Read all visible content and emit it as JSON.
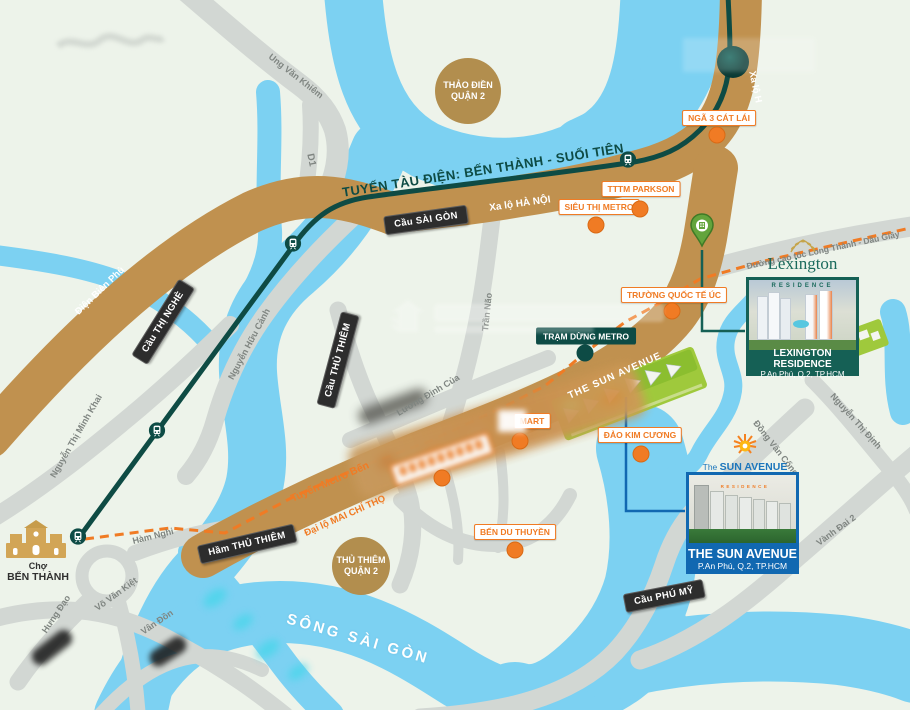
{
  "palette": {
    "land": "#EDF3EA",
    "water": "#7CD1F2",
    "road_gray": "#D2D7D3",
    "road_brown": "#C0914F",
    "metro_teal": "#0E4B44",
    "poi_orange": "#F07B24",
    "bridge_label": "#2D2D2D",
    "district_circle": "#B28E4E",
    "lexington_teal": "#156055",
    "sun_blue": "#1168B1"
  },
  "labels": {
    "streets": [
      {
        "n": "street-ung-van-khiem",
        "t": "Ung Văn Khiêm",
        "x": 296,
        "y": 76,
        "r": 38,
        "s": 9
      },
      {
        "n": "street-d1",
        "t": "D1",
        "x": 311,
        "y": 160,
        "r": 78,
        "s": 10
      },
      {
        "n": "street-nguyen-huu-canh",
        "t": "Nguyễn Hữu Cảnh",
        "x": 249,
        "y": 344,
        "r": -62,
        "s": 9
      },
      {
        "n": "street-nguyen-thi-minh-khai",
        "t": "Nguyễn Thị Minh Khai",
        "x": 76,
        "y": 436,
        "r": -60,
        "s": 9
      },
      {
        "n": "street-tran-nao",
        "t": "Trần Não",
        "x": 487,
        "y": 312,
        "r": -84,
        "s": 9
      },
      {
        "n": "street-luong-dinh-cua",
        "t": "Lương Định Của",
        "x": 428,
        "y": 395,
        "r": -31,
        "s": 9
      },
      {
        "n": "street-ham-nghi",
        "t": "Hàm Nghi",
        "x": 153,
        "y": 536,
        "r": -14,
        "s": 9
      },
      {
        "n": "street-vo-van-kiet",
        "t": "Võ Văn Kiệt",
        "x": 116,
        "y": 594,
        "r": -36,
        "s": 9
      },
      {
        "n": "street-van-don",
        "t": "Vân Đồn",
        "x": 157,
        "y": 622,
        "r": -34,
        "s": 9
      },
      {
        "n": "street-hung-dao",
        "t": "Hưng Đạo",
        "x": 56,
        "y": 614,
        "r": -56,
        "s": 9
      },
      {
        "n": "street-dong-van-cong",
        "t": "Đồng Văn Cống",
        "x": 776,
        "y": 448,
        "r": 52,
        "s": 9
      },
      {
        "n": "street-nguyen-thi-dinh",
        "t": "Nguyễn Thị Định",
        "x": 856,
        "y": 421,
        "r": 48,
        "s": 9
      },
      {
        "n": "street-vanh-dai-2",
        "t": "Vành Đai 2",
        "x": 836,
        "y": 530,
        "r": -36,
        "s": 9
      },
      {
        "n": "street-cao-toc-long-thanh",
        "t": "Đường cao tốc Long Thành - Dầu Giây",
        "x": 823,
        "y": 250,
        "r": -12,
        "s": 8.5
      }
    ],
    "road_white": [
      {
        "n": "road-dien-bien-phu",
        "t": "Điện Biên Phủ",
        "x": 100,
        "y": 291,
        "r": -44,
        "s": 9.5
      },
      {
        "n": "road-xa-lo-ha-noi",
        "t": "Xa lộ HÀ NỘI",
        "x": 520,
        "y": 204,
        "r": -8,
        "s": 10
      },
      {
        "n": "road-the-sun-avenue",
        "t": "THE SUN AVENUE",
        "x": 615,
        "y": 376,
        "r": -24,
        "s": 10,
        "ls": 1
      },
      {
        "n": "road-xa-lo-h",
        "t": "Xa lộ H",
        "x": 755,
        "y": 87,
        "r": 78,
        "s": 9.5
      }
    ],
    "road_orange": [
      {
        "n": "road-mai-chi-tho",
        "t": "Đại lộ MAI CHÍ THỌ",
        "x": 345,
        "y": 516,
        "r": -24,
        "s": 9.5
      },
      {
        "n": "road-tuyen-metro",
        "t": "Tuyến Metro Bến",
        "x": 330,
        "y": 482,
        "r": -24,
        "s": 10.5
      }
    ],
    "metro_line_label": {
      "n": "metro-line-label",
      "t": "TUYẾN TÀU ĐIỆN: BẾN THÀNH - SUỐI TIÊN",
      "x": 483,
      "y": 170,
      "r": -9,
      "s": 13
    },
    "river_label": {
      "n": "river-name",
      "t": "SÔNG SÀI GÒN",
      "x": 358,
      "y": 639,
      "r": 16,
      "s": 15
    },
    "districts": [
      {
        "n": "district-thao-dien",
        "l1": "THẢO ĐIỀN",
        "l2": "QUẬN 2",
        "x": 468,
        "y": 91,
        "d": 66
      },
      {
        "n": "district-thu-thiem",
        "l1": "THỦ THIÊM",
        "l2": "QUẬN 2",
        "x": 361,
        "y": 566,
        "d": 58
      }
    ],
    "bridges": [
      {
        "n": "bridge-cau-sai-gon",
        "t": "Cầu SÀI GÒN",
        "x": 426,
        "y": 220,
        "r": -8
      },
      {
        "n": "bridge-cau-thi-nghe",
        "t": "Cầu THỊ NGHÈ",
        "x": 163,
        "y": 322,
        "r": -58
      },
      {
        "n": "bridge-cau-thu-thiem",
        "t": "Cầu THỦ THIÊM",
        "x": 338,
        "y": 360,
        "r": -75
      },
      {
        "n": "bridge-ham-thu-thiem",
        "t": "Hầm THỦ THIÊM",
        "x": 247,
        "y": 544,
        "r": -13
      },
      {
        "n": "bridge-cau-phu-my",
        "t": "Cầu PHÚ MỸ",
        "x": 664,
        "y": 596,
        "r": -11
      }
    ],
    "pois": [
      {
        "n": "poi-nga-3-cat-lai",
        "t": "NGÃ 3 CÁT LÁI",
        "x": 719,
        "y": 118,
        "dot": [
          717,
          135
        ]
      },
      {
        "n": "poi-tttm-parkson",
        "t": "TTTM PARKSON",
        "x": 641,
        "y": 189,
        "dot": [
          640,
          209
        ]
      },
      {
        "n": "poi-sieu-thi-metro",
        "t": "SIÊU THỊ METRO",
        "x": 599,
        "y": 207,
        "dot": [
          596,
          225
        ]
      },
      {
        "n": "poi-truong-quoc-te-uc",
        "t": "TRƯỜNG QUỐC TẾ ÚC",
        "x": 674,
        "y": 295,
        "dot": [
          672,
          311
        ]
      },
      {
        "n": "poi-mart",
        "t": "MART",
        "x": 532,
        "y": 421,
        "dot": [
          520,
          441
        ]
      },
      {
        "n": "poi-dao-kim-cuong",
        "t": "ĐẢO KIM CƯƠNG",
        "x": 640,
        "y": 435,
        "dot": [
          641,
          454
        ]
      },
      {
        "n": "poi-ben-du-thuyen",
        "t": "BẾN DU THUYỀN",
        "x": 515,
        "y": 532,
        "dot": [
          515,
          550
        ]
      }
    ],
    "poi_dark": [
      {
        "n": "poi-tram-dung-metro",
        "t": "TRẠM DỪNG METRO",
        "x": 586,
        "y": 336,
        "dot": [
          585,
          353
        ]
      }
    ]
  },
  "metro": {
    "stations": [
      [
        78,
        539
      ],
      [
        157,
        433
      ],
      [
        293,
        246
      ],
      [
        628,
        162
      ]
    ],
    "terminal": [
      733,
      62
    ]
  },
  "extra_dots": [
    [
      442,
      478
    ]
  ],
  "ben_thanh": {
    "line1": "Chợ",
    "line2": "BẾN THÀNH"
  },
  "lexington": {
    "logo": "Lexington",
    "logo_sub": "RESIDENCE",
    "title": "LEXINGTON RESIDENCE",
    "address": "P.An Phú, Q.2, TP.HCM"
  },
  "sun_avenue": {
    "logo_the": "The",
    "logo_main": "SUN AVENUE",
    "logo_sub": "RESIDENCE",
    "title": "THE SUN AVENUE",
    "address": "P.An Phú, Q.2, TP.HCM"
  }
}
